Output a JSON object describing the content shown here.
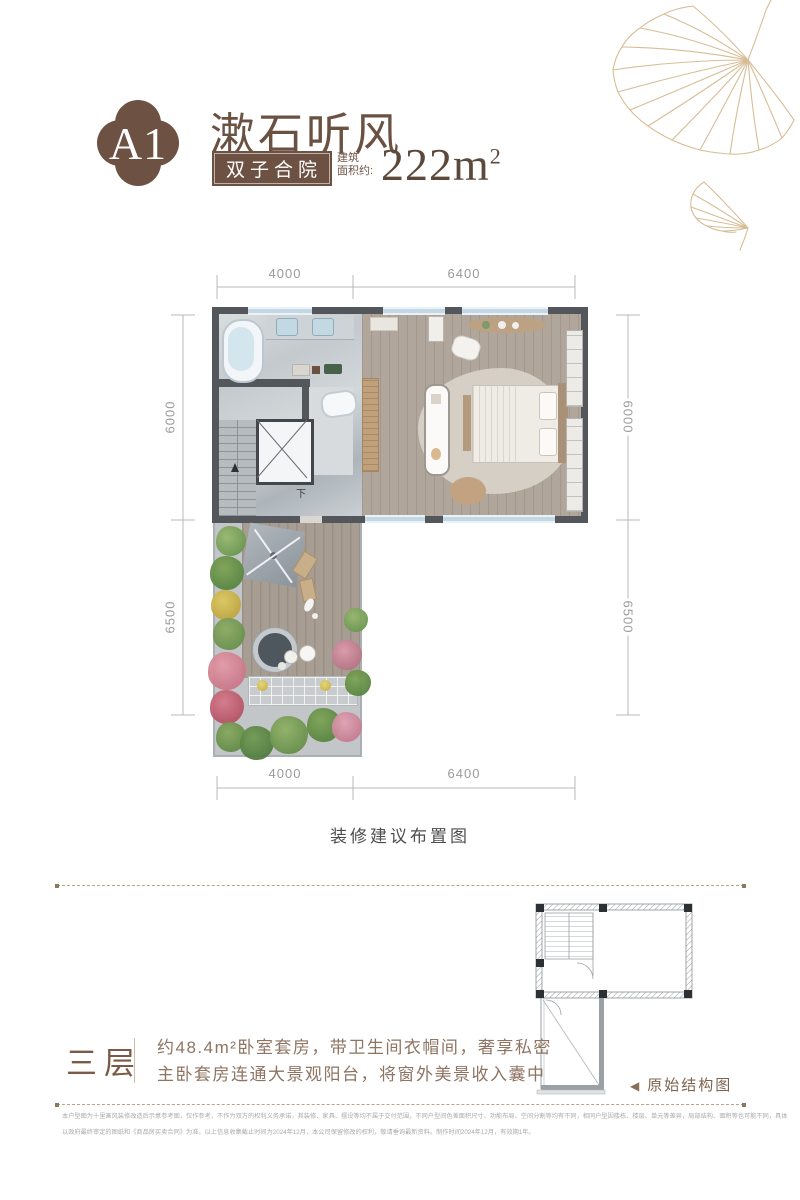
{
  "colors": {
    "brand_brown": "#6d5243",
    "leaf_tan": "#d7bd95",
    "wall_gray": "#53575b",
    "window_blue": "#c3d8e4"
  },
  "header": {
    "badge": "A1",
    "title": "漱石听风",
    "tag": "双子合院",
    "area_label_line1": "建筑",
    "area_label_line2": "面积约:",
    "area_value": "222m",
    "area_sup": "2"
  },
  "plan": {
    "caption": "装修建议布置图",
    "stair_label": "下",
    "dims": {
      "top": [
        "4000",
        "6400"
      ],
      "bottom": [
        "4000",
        "6400"
      ],
      "left": [
        "6000",
        "6500"
      ],
      "right": [
        "6000",
        "6500"
      ]
    }
  },
  "info": {
    "floor_label": "三层",
    "desc_line1": "约48.4m²卧室套房，带卫生间衣帽间，奢享私密",
    "desc_line2": "主卧套房连通大景观阳台，将窗外美景收入囊中"
  },
  "structure": {
    "arrow": "◀",
    "label": "原始结构图"
  },
  "disclaimer": {
    "line1": "本户型图为十里画风装修改造后示意参考图，仅作参考，不作为双方的权利义务承诺，其装修、家具、摆设等均不属于交付范围，不同户型间色差面积尺寸、功能布局、空间分割等均有不同，相同户型因楼栋、楼层、单元等差异，局部结构、面积等也可能不同，具体",
    "line2": "以政府最终审定的图纸和《商品房买卖合同》为准。以上信息收集截止时间为2024年12月，本公司保留修改的权利，敬请垂询最新资料。制作时间2024年12月，有效期1年。"
  }
}
